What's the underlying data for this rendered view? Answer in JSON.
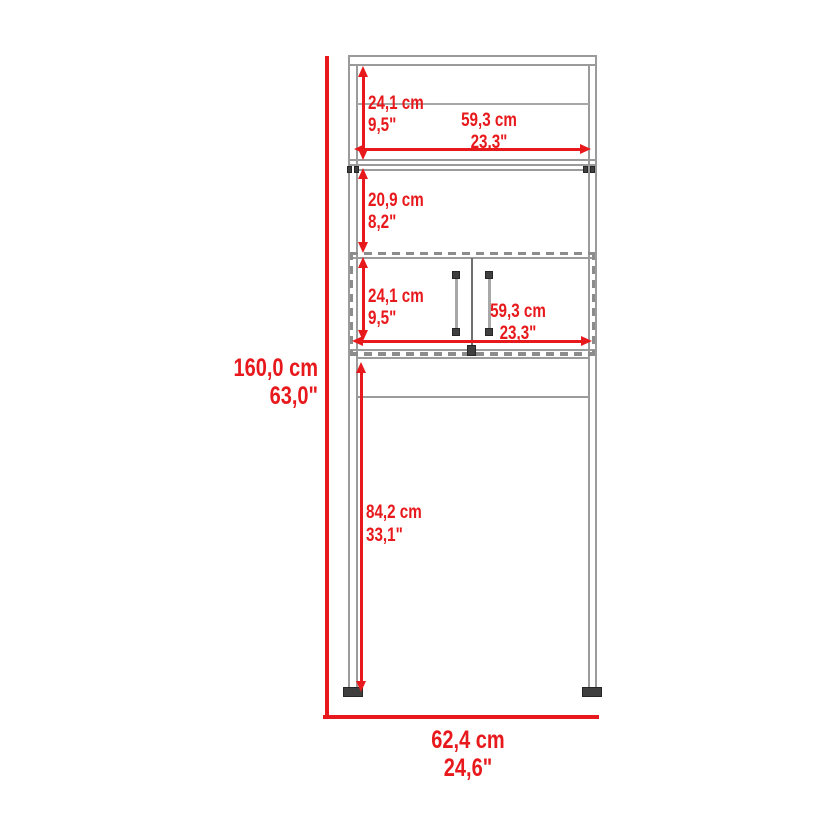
{
  "diagram": {
    "type": "product-dimension-diagram",
    "colors": {
      "dimension_red": "#e8191c",
      "outline_gray": "#9b9b9b",
      "hardware_dark": "#3f3f3f"
    },
    "dims": {
      "overall_height": {
        "cm": "160,0 cm",
        "in": "63,0\""
      },
      "overall_width": {
        "cm": "62,4 cm",
        "in": "24,6\""
      },
      "hutch_height": {
        "cm": "24,1 cm",
        "in": "9,5\""
      },
      "hutch_width": {
        "cm": "59,3 cm",
        "in": "23,3\""
      },
      "open_shelf_height": {
        "cm": "20,9 cm",
        "in": "8,2\""
      },
      "cabinet_height": {
        "cm": "24,1 cm",
        "in": "9,5\""
      },
      "cabinet_width": {
        "cm": "59,3 cm",
        "in": "23,3\""
      },
      "clearance_height": {
        "cm": "84,2 cm",
        "in": "33,1\""
      }
    }
  }
}
